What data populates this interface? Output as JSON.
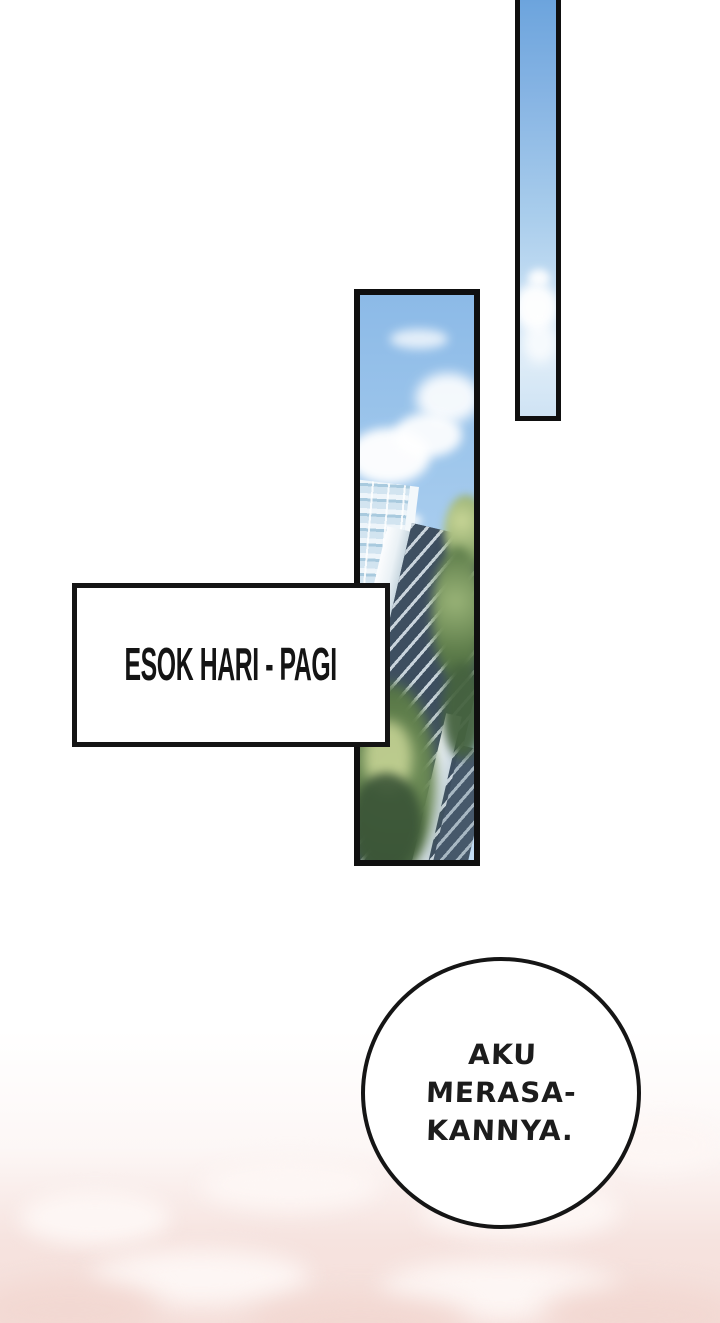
{
  "page": {
    "background": "#ffffff"
  },
  "colors": {
    "ink": "#0f0f0f",
    "sky_deep": "#6ca4dd",
    "sky_mid": "#a9cdec",
    "sky_pale": "#c6def3",
    "cloud_white": "#ffffff",
    "glass_blue": "#9ec7e2",
    "glass_deep": "#6fa3c6",
    "facade_dark": "#3f5062",
    "tree_green": "#5d7c4a",
    "tree_light": "#c9d697",
    "tree_dark": "#3a5437",
    "pink_base": "#f6e3df",
    "pink_light": "#fdf6f4",
    "pink_deep": "#f2d8d2"
  },
  "caption_box": {
    "text": "ESOK HARI - PAGI"
  },
  "speech_bubble": {
    "lines": [
      "AKU",
      "MERASA-",
      "KANNYA."
    ]
  }
}
